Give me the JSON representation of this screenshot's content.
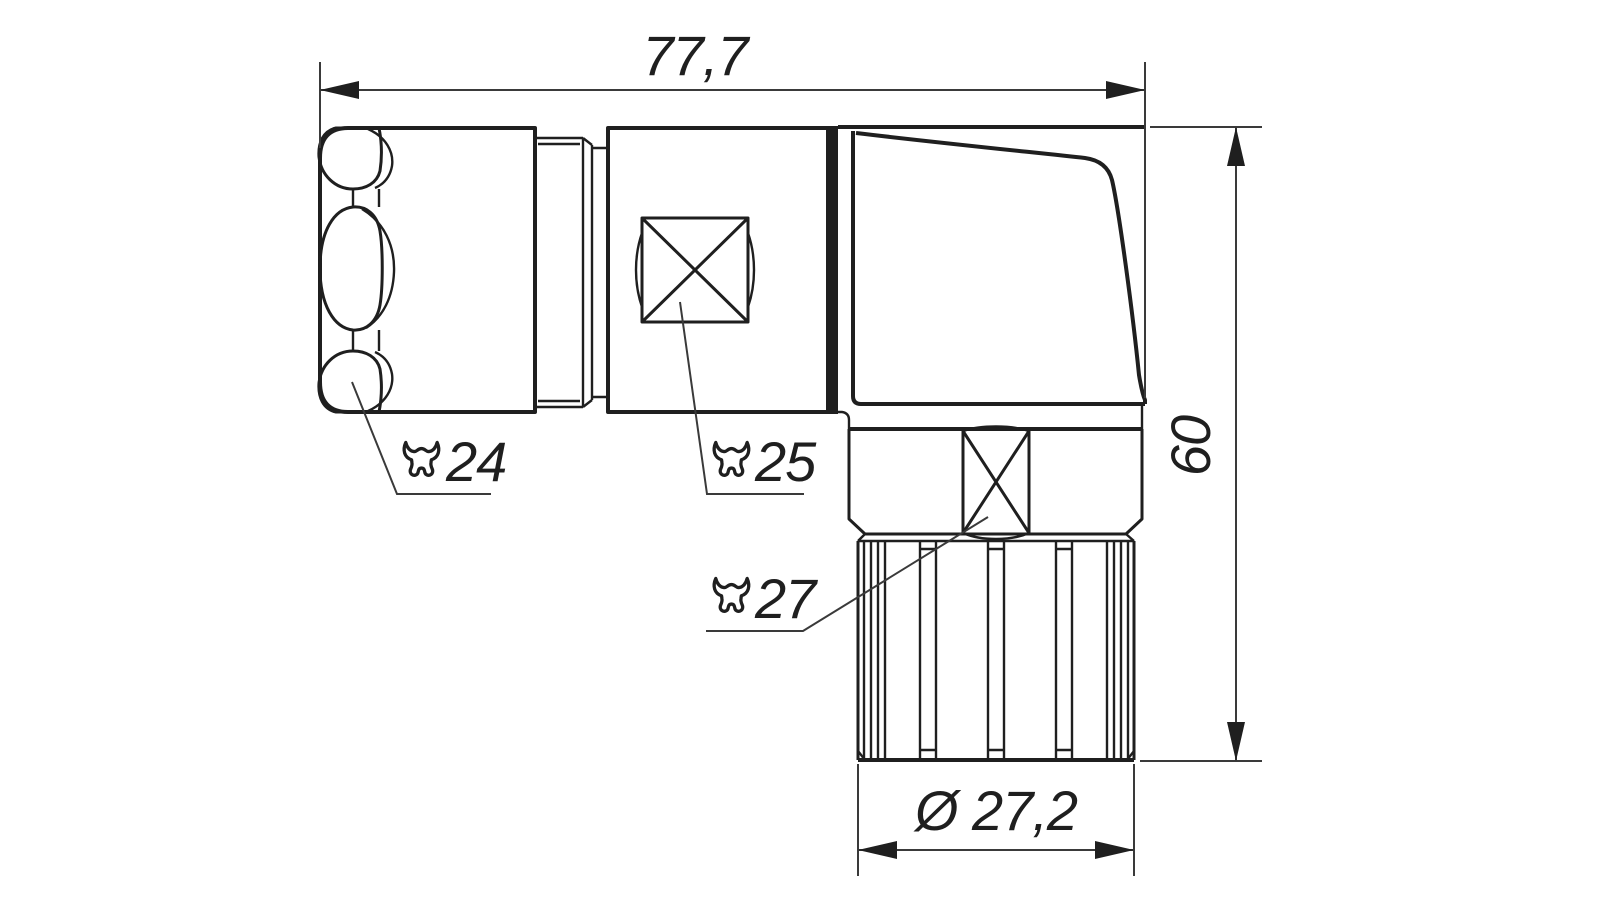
{
  "canvas": {
    "background": "#ffffff",
    "line_color": "#1f1f1f"
  },
  "dimensions": {
    "overall_length": {
      "label": "77,7",
      "orientation": "horizontal"
    },
    "overall_height": {
      "label": "60",
      "orientation": "vertical"
    },
    "sleeve_diameter": {
      "label": "Ø 27,2",
      "orientation": "horizontal"
    }
  },
  "callouts": {
    "gland_nut": {
      "label": "24",
      "icon": "wrench-icon"
    },
    "body_flats": {
      "label": "25",
      "icon": "wrench-icon"
    },
    "coupling_nut": {
      "label": "27",
      "icon": "wrench-icon"
    }
  }
}
